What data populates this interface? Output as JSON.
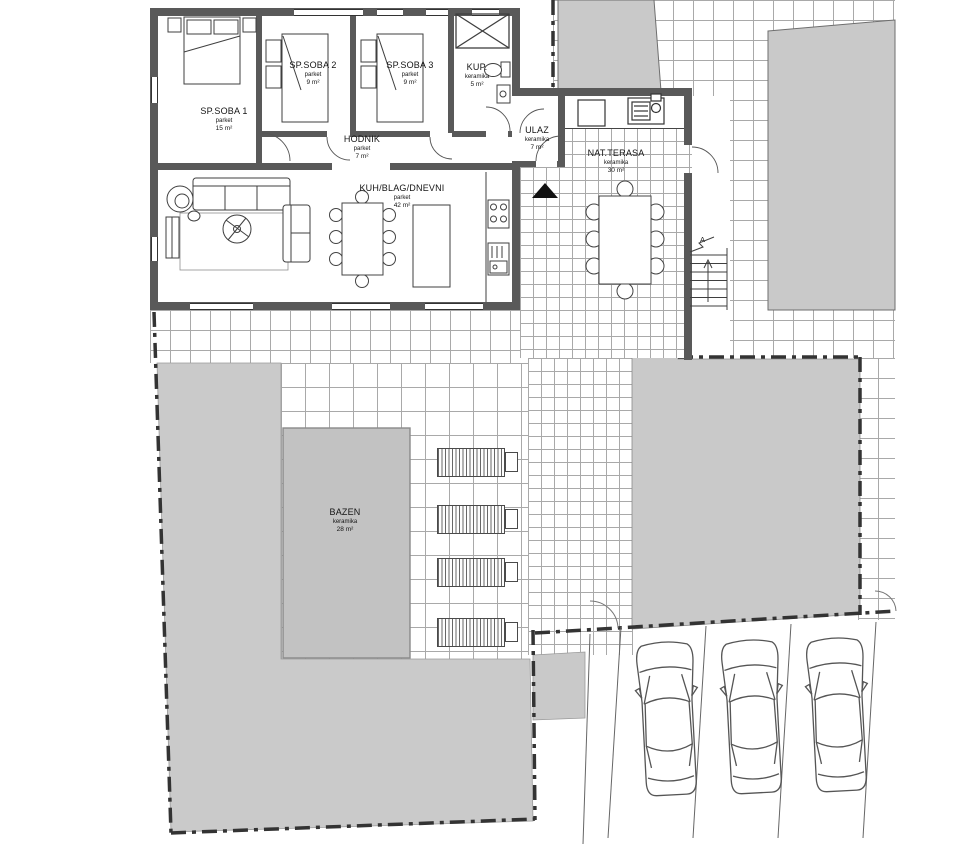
{
  "rooms": [
    {
      "name": "SP.SOBA 1",
      "floor": "parket",
      "area": "15 m²"
    },
    {
      "name": "SP.SOBA 2",
      "floor": "parket",
      "area": "9 m²"
    },
    {
      "name": "SP.SOBA 3",
      "floor": "parket",
      "area": "9 m²"
    },
    {
      "name": "KUP.",
      "floor": "keramika",
      "area": "5 m²"
    },
    {
      "name": "HODNIK",
      "floor": "parket",
      "area": "7 m²"
    },
    {
      "name": "KUH/BLAG/DNEVNI",
      "floor": "parket",
      "area": "42 m²"
    },
    {
      "name": "ULAZ",
      "floor": "keramika",
      "area": "7 m²"
    },
    {
      "name": "NAT.TERASA",
      "floor": "keramika",
      "area": "30 m²"
    },
    {
      "name": "BAZEN",
      "floor": "keramika",
      "area": "28 m²"
    }
  ],
  "markers": {
    "stairs": "A"
  },
  "colors": {
    "wall": "#595959",
    "parcel_fill": "#c9c9c9",
    "lawn_fill": "#cacaca",
    "pool_fill": "#c2c2c2",
    "tile_line": "#a9a9a9",
    "boundary": "#333333"
  }
}
